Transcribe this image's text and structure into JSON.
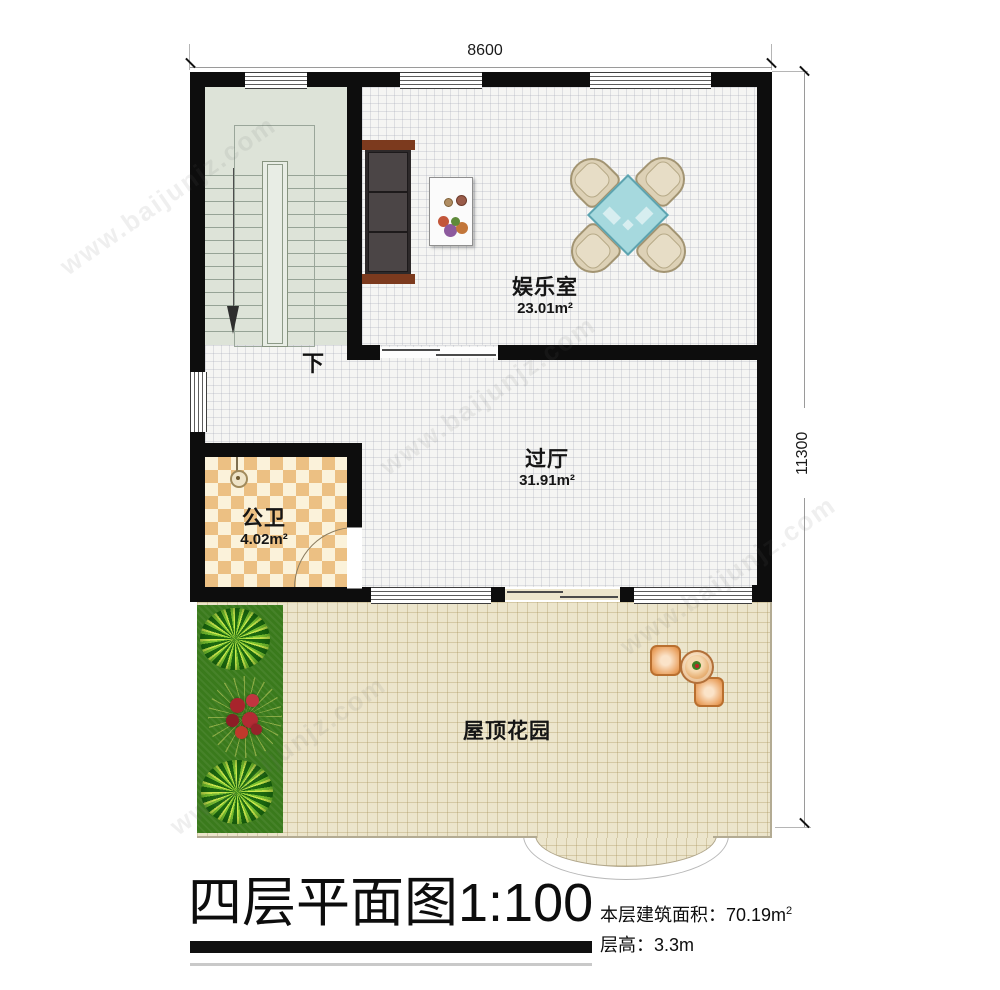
{
  "title": {
    "main": "四层平面图1:100"
  },
  "info": {
    "line1_label": "本层建筑面积：",
    "line1_value": "70.19m",
    "line1_sup": "2",
    "line2_label": "层高：",
    "line2_value": "3.3m"
  },
  "dims": {
    "width": "8600",
    "height": "11300"
  },
  "rooms": {
    "entertainment": {
      "name": "娱乐室",
      "area": "23.01m²"
    },
    "hall": {
      "name": "过厅",
      "area": "31.91m²"
    },
    "bath": {
      "name": "公卫",
      "area": "4.02m²"
    },
    "garden": {
      "name": "屋顶花园"
    }
  },
  "stairs": {
    "down": "下"
  },
  "watermark": {
    "text": "www.baijunjz.com"
  },
  "colors": {
    "wall": "#0d0d0d",
    "stair_floor": "#dde3d8",
    "bath_tile_a": "#ecc083",
    "bath_tile_b": "#fbf2da",
    "garden_tile": "#ece5cc",
    "grass": "#3a7a1c",
    "game_table": "#a6d9de",
    "chair": "#ddd1b6",
    "sofa_wood": "#7c3a1e"
  }
}
